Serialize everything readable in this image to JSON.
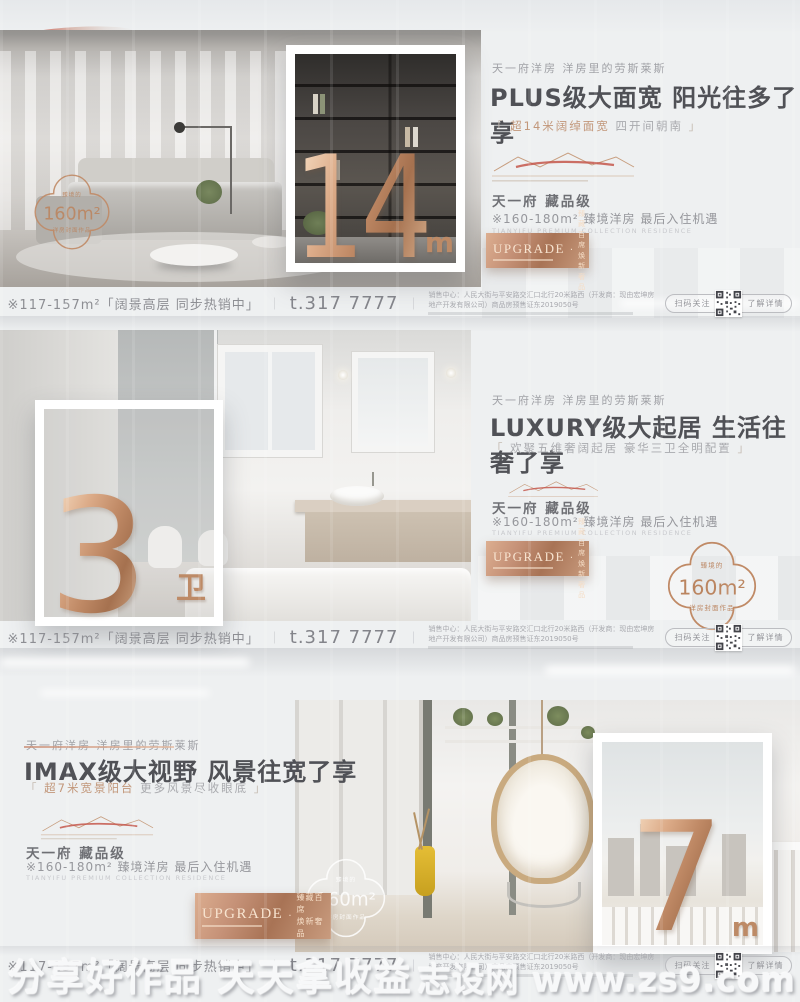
{
  "colors": {
    "copper": "#c08a66",
    "copper_light": "#e8c5a8",
    "ink": "#505156",
    "grey": "#98999e",
    "red_swoosh": "#c7524a"
  },
  "watermark": {
    "left": "分享好作品 天天拿收益",
    "right": "志设网 www.zs9.com"
  },
  "shared": {
    "eyebrow": "天一府洋房 洋房里的劳斯莱斯",
    "project": "天一府 藏品级",
    "detail": "※160-180m² 臻境洋房 最后入住机遇",
    "detail_en": "TIANYIFU PREMIUM COLLECTION RESIDENCE",
    "plaque_title": "UPGRADE",
    "plaque_dot": "·",
    "plaque_line1": "臻藏百席",
    "plaque_line2": "焕新奢品"
  },
  "strip": {
    "range": "※117-157m²「阔景高层 同步热销中」",
    "sep": "｜",
    "phone": "t.317 7777",
    "address": "销售中心：人民大街与平安路交汇口北行20米路西（开发商：现由宏坤房地产开发有限公司）商品房预售证东2019050号",
    "qr_left": "扫码关注",
    "qr_right": "了解详情"
  },
  "panels": [
    {
      "headline": "PLUS级大面宽 阳光往多了享",
      "sub_open": "「",
      "sub_hl": "超14米阔绰面宽",
      "sub_rest": "四开间朝南",
      "sub_close": "」",
      "number": "14",
      "unit": "m",
      "badge_top": "臻境的",
      "badge_value": "160m²",
      "badge_bottom": "洋房封面作品"
    },
    {
      "headline": "LUXURY级大起居 生活往奢了享",
      "sub_open": "「",
      "sub_hl": "欢聚五维奢阔起居",
      "sub_rest": "豪华三卫全明配置",
      "sub_close": "」",
      "number": "3",
      "unit": "卫",
      "badge_top": "臻境的",
      "badge_value": "160m²",
      "badge_bottom": "洋房封面作品"
    },
    {
      "headline": "IMAX级大视野 风景往宽了享",
      "sub_open": "「",
      "sub_hl": "超7米宽景阳台",
      "sub_rest": "更多风景尽收眼底",
      "sub_close": "」",
      "number": "7",
      "unit": "m",
      "badge_top": "臻境的",
      "badge_value": "160m²",
      "badge_bottom": "洋房封面作品"
    }
  ]
}
